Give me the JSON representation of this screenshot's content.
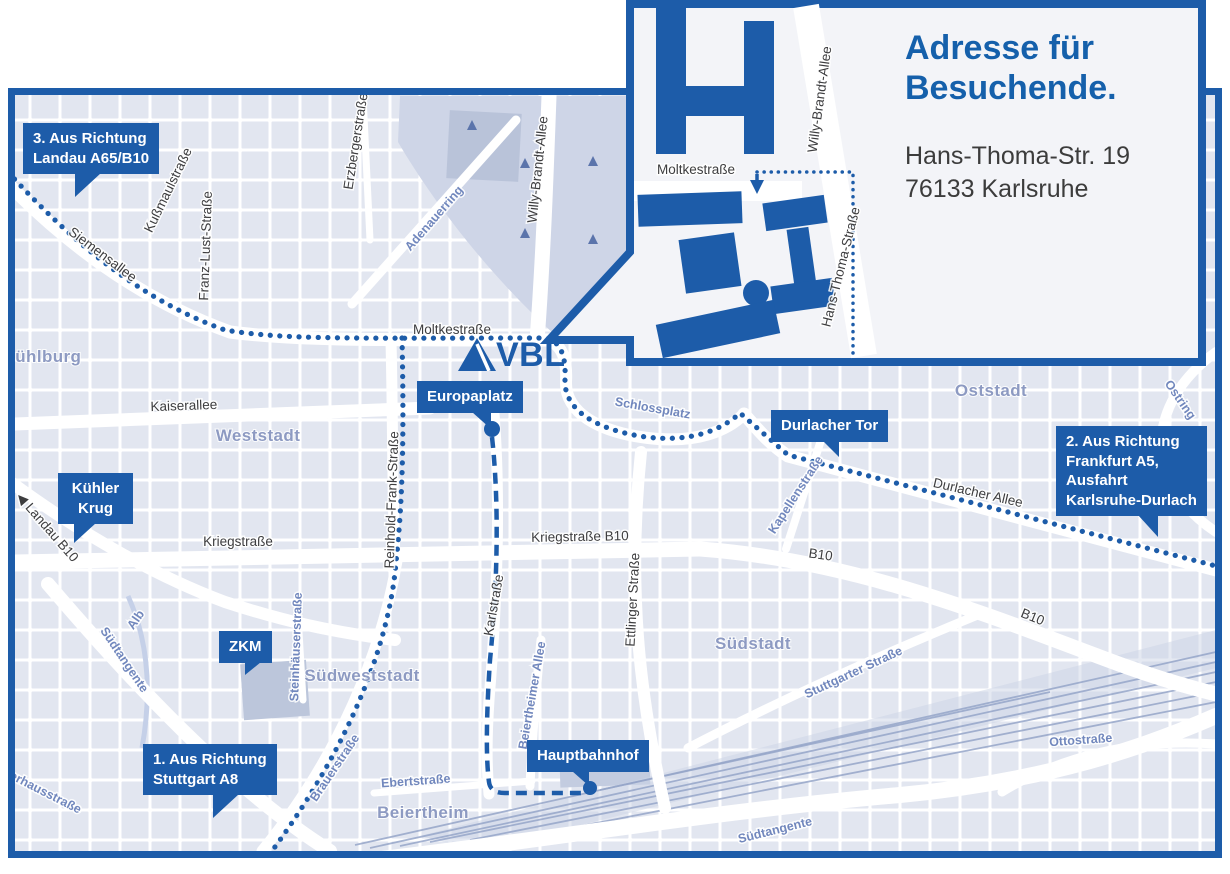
{
  "colors": {
    "brand_blue": "#1d5ca9",
    "title_blue": "#1560ab",
    "map_bg": "#eef0f7",
    "block": "#e2e6f0",
    "park": "#ced5e7",
    "district_text": "#8d9ac2",
    "street_blue_text": "#7187bd",
    "street_dark_text": "#3d3d3f"
  },
  "logo": {
    "text": "VBL"
  },
  "inset": {
    "title_line1": "Adresse für",
    "title_line2": "Besuchende.",
    "address_line1": "Hans-Thoma-Str. 19",
    "address_line2": "76133 Karlsruhe",
    "labels": [
      {
        "text": "Moltkestraße",
        "x": 156,
        "y": 174,
        "rotate": 0,
        "type": "dark"
      },
      {
        "text": "Willy-Brandt-Allee",
        "x": 284,
        "y": 100,
        "rotate": -82,
        "type": "dark"
      },
      {
        "text": "Hans-Thoma-Straße",
        "x": 305,
        "y": 268,
        "rotate": -76,
        "type": "dark"
      }
    ]
  },
  "badges": [
    {
      "id": "richtung-landau",
      "lines": [
        "3. Aus Richtung",
        "Landau A65/B10"
      ],
      "x": 23,
      "y": 123,
      "pointer": {
        "left": 52,
        "dir": "left",
        "h": 24,
        "w": 26
      }
    },
    {
      "id": "kuehler-krug",
      "lines": [
        "Kühler",
        "Krug"
      ],
      "x": 58,
      "y": 473,
      "center": true,
      "w": 55,
      "pointer": {
        "left": 16,
        "dir": "left",
        "h": 20,
        "w": 22
      }
    },
    {
      "id": "zkm",
      "lines": [
        "ZKM"
      ],
      "x": 219,
      "y": 631,
      "center": true,
      "pointer": {
        "left": 26,
        "dir": "left",
        "h": 13,
        "w": 16
      }
    },
    {
      "id": "richtung-stuttgart",
      "lines": [
        "1. Aus Richtung",
        "Stuttgart A8"
      ],
      "x": 143,
      "y": 744,
      "pointer": {
        "left": 70,
        "dir": "left",
        "h": 24,
        "w": 26
      }
    },
    {
      "id": "europaplatz",
      "lines": [
        "Europaplatz"
      ],
      "x": 417,
      "y": 381,
      "pointer": {
        "left": 55,
        "dir": "right",
        "h": 17,
        "w": 19
      },
      "dot": {
        "x": 492,
        "y": 429,
        "r": 8
      }
    },
    {
      "id": "durlacher-tor",
      "lines": [
        "Durlacher Tor"
      ],
      "x": 771,
      "y": 410,
      "pointer": {
        "left": 52,
        "dir": "right",
        "h": 16,
        "w": 16
      }
    },
    {
      "id": "richtung-frankfurt",
      "lines": [
        "2. Aus Richtung",
        "Frankfurt A5,",
        "Ausfahrt",
        "Karlsruhe-Durlach"
      ],
      "x": 1056,
      "y": 426,
      "pointer": {
        "left": 82,
        "dir": "right",
        "h": 22,
        "w": 20
      }
    },
    {
      "id": "hauptbahnhof",
      "lines": [
        "Hauptbahnhof"
      ],
      "x": 527,
      "y": 740,
      "pointer": {
        "left": 45,
        "dir": "right",
        "h": 15,
        "w": 17
      },
      "dot": {
        "x": 590,
        "y": 788,
        "r": 7
      }
    }
  ],
  "map_labels": [
    {
      "text": "Siemensallee",
      "x": 100,
      "y": 258,
      "rotate": 37,
      "type": "dark"
    },
    {
      "text": "Kußmaulstraße",
      "x": 172,
      "y": 192,
      "rotate": -64,
      "type": "dark"
    },
    {
      "text": "Franz-Lust-Straße",
      "x": 210,
      "y": 246,
      "rotate": -88,
      "type": "dark"
    },
    {
      "text": "Erzbergerstraße",
      "x": 360,
      "y": 142,
      "rotate": -81,
      "type": "dark"
    },
    {
      "text": "Adenauerring",
      "x": 437,
      "y": 221,
      "rotate": -49,
      "type": "blue"
    },
    {
      "text": "Willy-Brandt-Allee",
      "x": 542,
      "y": 170,
      "rotate": -84,
      "type": "dark"
    },
    {
      "text": "Moltkestraße",
      "x": 452,
      "y": 334,
      "rotate": 0,
      "type": "dark"
    },
    {
      "text": "Mühlburg",
      "x": 41,
      "y": 362,
      "rotate": 0,
      "type": "district"
    },
    {
      "text": "Kaiserallee",
      "x": 184,
      "y": 410,
      "rotate": -2,
      "type": "dark"
    },
    {
      "text": "Weststadt",
      "x": 258,
      "y": 441,
      "rotate": 0,
      "type": "district"
    },
    {
      "text": "Schlossplatz",
      "x": 652,
      "y": 412,
      "rotate": 10,
      "type": "blue"
    },
    {
      "text": "Oststadt",
      "x": 991,
      "y": 396,
      "rotate": 0,
      "type": "district"
    },
    {
      "text": "Ostring",
      "x": 1177,
      "y": 402,
      "rotate": 55,
      "type": "blue"
    },
    {
      "text": "Kapellenstraße",
      "x": 799,
      "y": 497,
      "rotate": -57,
      "type": "blue"
    },
    {
      "text": "Durlacher Allee",
      "x": 977,
      "y": 497,
      "rotate": 13,
      "type": "dark"
    },
    {
      "text": "B10",
      "x": 820,
      "y": 559,
      "rotate": 8,
      "type": "dark"
    },
    {
      "text": "B10",
      "x": 1031,
      "y": 621,
      "rotate": 22,
      "type": "dark"
    },
    {
      "text": "◀ Landau B10",
      "x": 44,
      "y": 530,
      "rotate": 49,
      "type": "dark"
    },
    {
      "text": "Kriegstraße",
      "x": 238,
      "y": 546,
      "rotate": 0,
      "type": "dark"
    },
    {
      "text": "Kriegstraße B10",
      "x": 580,
      "y": 541,
      "rotate": -1,
      "type": "dark"
    },
    {
      "text": "Reinhold-Frank-Straße",
      "x": 396,
      "y": 500,
      "rotate": -88,
      "type": "dark"
    },
    {
      "text": "Karlstraße",
      "x": 498,
      "y": 606,
      "rotate": -80,
      "type": "dark"
    },
    {
      "text": "Ettlinger Straße",
      "x": 637,
      "y": 600,
      "rotate": -87,
      "type": "dark"
    },
    {
      "text": "Südstadt",
      "x": 753,
      "y": 649,
      "rotate": 0,
      "type": "district"
    },
    {
      "text": "Stuttgarter Straße",
      "x": 855,
      "y": 676,
      "rotate": -25,
      "type": "blue"
    },
    {
      "text": "Steinhäuserstraße",
      "x": 300,
      "y": 647,
      "rotate": -88,
      "type": "blue"
    },
    {
      "text": "Südweststadt",
      "x": 362,
      "y": 681,
      "rotate": 0,
      "type": "district"
    },
    {
      "text": "Alb",
      "x": 139,
      "y": 622,
      "rotate": -55,
      "type": "blue"
    },
    {
      "text": "Südtangente",
      "x": 121,
      "y": 662,
      "rotate": 56,
      "type": "blue"
    },
    {
      "text": "Brauerstraße",
      "x": 338,
      "y": 770,
      "rotate": -56,
      "type": "blue"
    },
    {
      "text": "Ebertstraße",
      "x": 416,
      "y": 785,
      "rotate": -4,
      "type": "blue"
    },
    {
      "text": "Beiertheimer Allee",
      "x": 536,
      "y": 696,
      "rotate": -80,
      "type": "blue"
    },
    {
      "text": "Beiertheim",
      "x": 423,
      "y": 818,
      "rotate": 0,
      "type": "district"
    },
    {
      "text": "Südtangente",
      "x": 776,
      "y": 834,
      "rotate": -14,
      "type": "blue"
    },
    {
      "text": "Ottostraße",
      "x": 1081,
      "y": 744,
      "rotate": -4,
      "type": "blue"
    },
    {
      "text": "Pulverhausstraße",
      "x": 32,
      "y": 790,
      "rotate": 27,
      "type": "blue"
    }
  ]
}
